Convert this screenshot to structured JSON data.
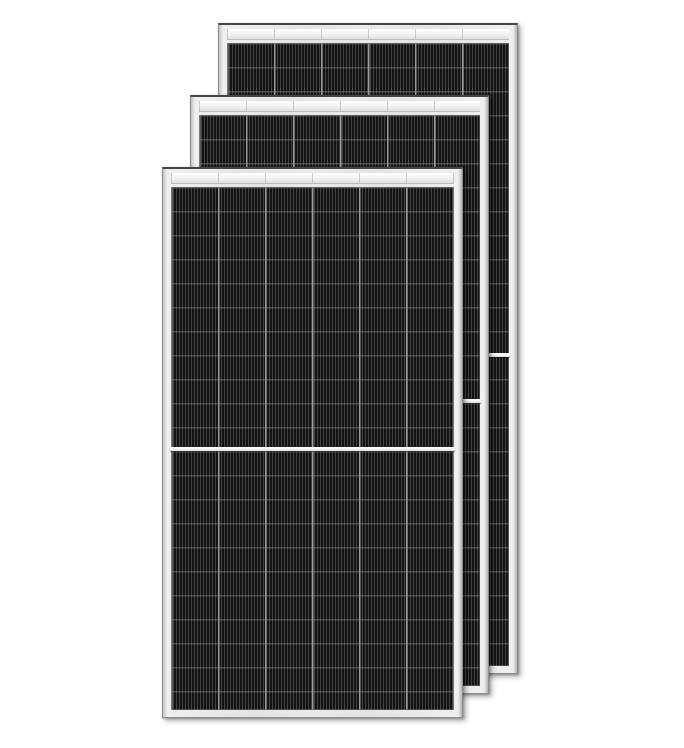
{
  "scene": {
    "description": "Product render of three framed monocrystalline half-cut solar PV modules overlapping in a diagonal cascade on a white background",
    "panel_count": 3
  },
  "colors": {
    "background": "#ffffff",
    "frame": "#e5e6e6",
    "frame_edge": "#8c8c8c",
    "frame_top_edge": "#454545",
    "top_strip": "#f4f4f4",
    "cell_dark": "#181818",
    "cell_stripe": "#424242",
    "column_divider": "#9b9b9b",
    "row_line": "#969696",
    "center_divider": "#f5f5f5"
  },
  "panels": [
    {
      "name": "back-panel",
      "left": 218,
      "top": 23,
      "width": 300,
      "height": 651,
      "z": 1,
      "columns": 6,
      "halves": 2
    },
    {
      "name": "middle-panel",
      "left": 190,
      "top": 95,
      "width": 299,
      "height": 599,
      "z": 2,
      "columns": 6,
      "halves": 2
    },
    {
      "name": "front-panel",
      "left": 162,
      "top": 167,
      "width": 301,
      "height": 551,
      "z": 3,
      "columns": 6,
      "halves": 2
    }
  ]
}
